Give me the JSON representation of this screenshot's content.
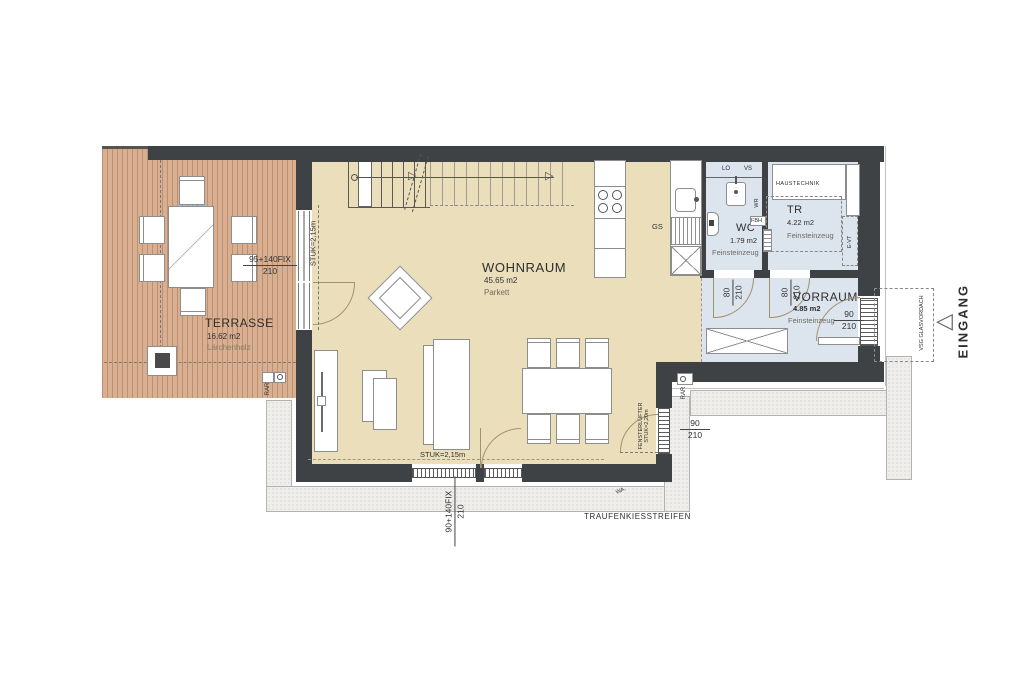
{
  "rooms": {
    "terrasse": {
      "name": "TERRASSE",
      "area": "16.62 m2",
      "finish": "Lärchenholz"
    },
    "wohnraum": {
      "name": "WOHNRAUM",
      "area": "45.65 m2",
      "finish": "Parkett"
    },
    "wc": {
      "name": "WC",
      "area": "1.79 m2",
      "finish": "Feinsteinzeug"
    },
    "tr": {
      "name": "TR",
      "area": "4.22 m2",
      "finish": "Feinsteinzeug"
    },
    "vorraum": {
      "name": "VORRAUM",
      "area": "4.85 m2",
      "finish": "Feinsteinzeug"
    }
  },
  "dimensions": {
    "terrace_door": {
      "width": "95+140FIX",
      "height": "210"
    },
    "south_door": {
      "width": "90+140FIX",
      "height": "210"
    },
    "east_window": {
      "width": "90",
      "height": "210"
    },
    "entry_door": {
      "width": "90",
      "height": "210"
    },
    "wc_door": {
      "width": "80",
      "height": "210"
    },
    "tr_door": {
      "width": "80",
      "height": "210"
    },
    "lintel_west": "STUK=2,15m",
    "lintel_south": "STUK=2,15m",
    "vent_lintel": "STUK=2,20m"
  },
  "annotations": {
    "haustechnik": "HAUSTECHNIK",
    "eingang": "EINGANG",
    "glass_canopy": "VSG GLASVORDACH",
    "gravel_strip": "TRAUFENKIESSTREIFEN",
    "window_vent": "FENSTERLÜFTER",
    "dishwasher": "GS",
    "lo": "LO",
    "vs": "VS",
    "wr": "WR",
    "fbh": "FBH",
    "evt": "E-VT",
    "rar": "RAR",
    "wa": "WA."
  },
  "colors": {
    "wall": "#3f4245",
    "terrace_wood": "#d9af91",
    "living_floor": "#ebdfbb",
    "tile_floor": "#dce4ee",
    "gravel": "#efeeec"
  }
}
